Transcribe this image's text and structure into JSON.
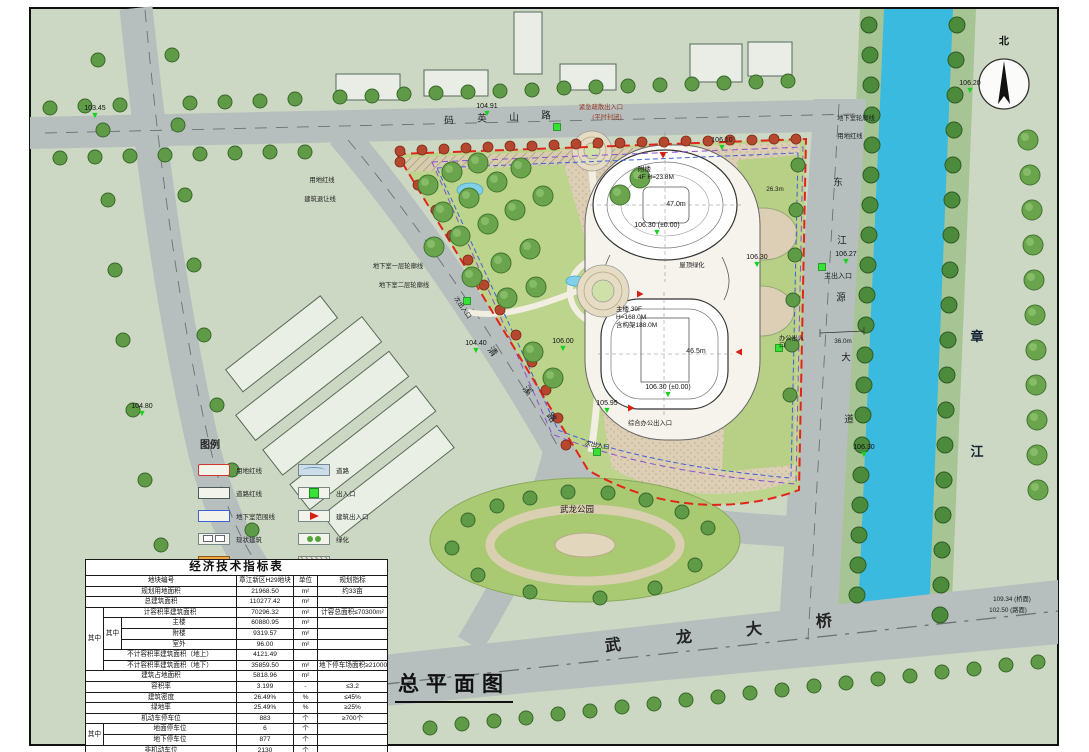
{
  "drawing": {
    "title": "总平面图",
    "compass_north": "北"
  },
  "roads": {
    "top": {
      "c1": "码",
      "c2": "英",
      "c3": "山",
      "c4": "路"
    },
    "right": {
      "c1": "东",
      "c2": "江",
      "c3": "源",
      "c4": "大",
      "c5": "道"
    },
    "left": {
      "c1": "清",
      "c2": "溪",
      "c3": "路"
    },
    "bridge": {
      "c1": "武",
      "c2": "龙",
      "c3": "大",
      "c4": "桥"
    }
  },
  "river": {
    "c1": "章",
    "c2": "江"
  },
  "park_label": "武龙公园",
  "buildings": {
    "annex": {
      "name": "附楼",
      "spec": "4F H=23.8M",
      "diameter": "47.0m",
      "elev": "106.30 (±0.00)"
    },
    "tower": {
      "name": "主楼 39F",
      "height": "H=168.0M",
      "frame": "含构架188.0M",
      "width": "46.5m",
      "elev": "106.30 (±0.00)"
    },
    "roof_green": "屋顶绿化"
  },
  "annotations": {
    "emergency_exit": "紧急疏散出入口",
    "emergency_note": "(平时封闭)",
    "basement_outline": "地下室轮廓线",
    "red_line_right": "用地红线",
    "red_line_left": "用地红线",
    "setback_line": "建筑退让线",
    "basement_l1": "地下室一层轮廓线",
    "basement_l2": "地下室二层轮廓线",
    "main_entrance": "主出入口",
    "secondary_entrance_w": "次出入口",
    "secondary_entrance_s": "次出入口",
    "office_entrance": "办公出入口",
    "combined_entrance": "综合办公出入口",
    "dim_26_3": "26.3m",
    "dim_36_0": "36.0m",
    "bridge_deck": "109.34 (桥面)",
    "bridge_road": "102.50 (路面)"
  },
  "elevations": {
    "e103_45": "103.45",
    "e104_91": "104.91",
    "e106_20": "106.20",
    "e106_10": "106.10",
    "e106_27": "106.27",
    "e106_30_mid": "106.30",
    "e104_40": "104.40",
    "e106_00": "106.00",
    "e105_95": "105.95",
    "e106_30_s": "106.30",
    "e104_80": "104.80"
  },
  "legend": {
    "title": "图例",
    "items": [
      {
        "label": "用地红线"
      },
      {
        "label": "道路红线"
      },
      {
        "label": "地下室范围线"
      },
      {
        "label": "现状建筑"
      },
      {
        "label": "拟建建筑"
      },
      {
        "label": "道路"
      },
      {
        "label": "出入口"
      },
      {
        "label": "建筑出入口"
      },
      {
        "label": "绿化"
      },
      {
        "label": "生态停车"
      }
    ]
  },
  "tbl": {
    "title": "经济技术指标表",
    "g_outer": "其中",
    "g_inner": "其中",
    "g_parking": "其中",
    "r1": [
      "地块编号",
      "章江新区H29地块",
      "单位",
      "规划指标"
    ],
    "r2": [
      "规划用地面积",
      "21968.50",
      "m²",
      "约33亩"
    ],
    "r3": [
      "总建筑面积",
      "110277.42",
      "m²",
      ""
    ],
    "r4": [
      "计容积率建筑面积",
      "70296.32",
      "m²",
      "计容总面积≤70300m²"
    ],
    "r5": [
      "主楼",
      "60880.95",
      "m²",
      ""
    ],
    "r6": [
      "附楼",
      "9319.57",
      "m²",
      ""
    ],
    "r7": [
      "室外",
      "96.00",
      "m²",
      ""
    ],
    "r8": [
      "不计容积率建筑面积（地上）",
      "4121.49",
      "",
      ""
    ],
    "r9": [
      "不计容积率建筑面积（地下）",
      "35859.50",
      "m²",
      "地下停车场面积≥21000m²"
    ],
    "r10": [
      "建筑占地面积",
      "5818.96",
      "m²",
      ""
    ],
    "r11": [
      "容积率",
      "3.199",
      "-",
      "≤3.2"
    ],
    "r12": [
      "建筑密度",
      "26.49%",
      "%",
      "≤45%"
    ],
    "r13": [
      "绿地率",
      "25.49%",
      "%",
      "≥25%"
    ],
    "r14": [
      "机动车停车位",
      "883",
      "个",
      "≥700个"
    ],
    "r15": [
      "地面停车位",
      "6",
      "个",
      ""
    ],
    "r16": [
      "地下停车位",
      "877",
      "个",
      ""
    ],
    "r17": [
      "非机动车位",
      "2130",
      "个",
      ""
    ]
  },
  "colors": {
    "river": "#3bbadf",
    "road": "#b6bfbe",
    "site_green": "#bcd48c",
    "red_line": "#e1251b",
    "entrance_marker": "#35e235",
    "elevation_marker": "#17d21f",
    "proposed_building": "#f4a542"
  }
}
